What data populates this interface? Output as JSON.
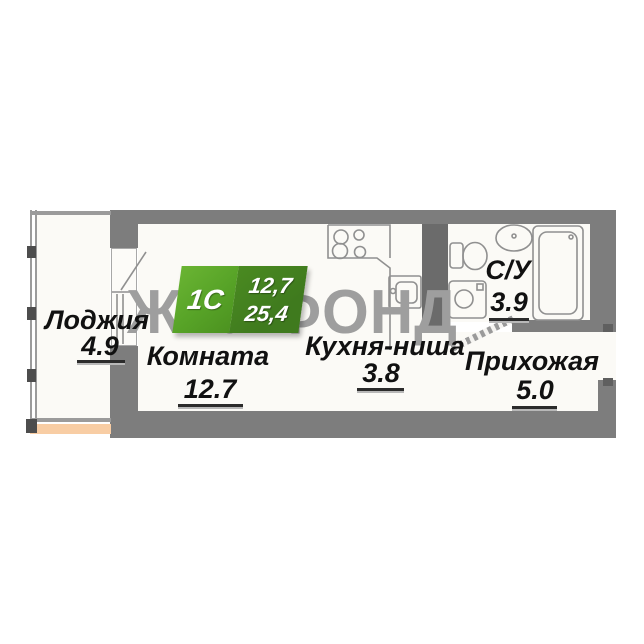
{
  "watermark": {
    "text": "ЖИЛФОНД"
  },
  "badge": {
    "type": "1С",
    "living_area": "12,7",
    "total_area": "25,4"
  },
  "rooms": [
    {
      "id": "loggia",
      "name": "Лоджия",
      "area": "4.9"
    },
    {
      "id": "room",
      "name": "Комната",
      "area": "12.7"
    },
    {
      "id": "kitchen",
      "name": "Кухня-ниша",
      "area": "3.8"
    },
    {
      "id": "hallway",
      "name": "Прихожая",
      "area": "5.0"
    },
    {
      "id": "bathroom",
      "name": "С/У",
      "area": "3.9"
    }
  ],
  "fixtures": [
    "stove",
    "kitchen-sink",
    "toilet",
    "washbasin",
    "bathtub",
    "washing-machine",
    "balcony-door",
    "bathroom-door",
    "entrance-opening"
  ],
  "colors": {
    "wall": "#7d7d7d",
    "shaft": "#6b6b6b",
    "interior": "#fbfaf6",
    "watermark": "#9e9e9e",
    "badge_light": "#57a327",
    "badge_dark": "#3f7a1e",
    "balcony_edge": "#f8cda4"
  }
}
